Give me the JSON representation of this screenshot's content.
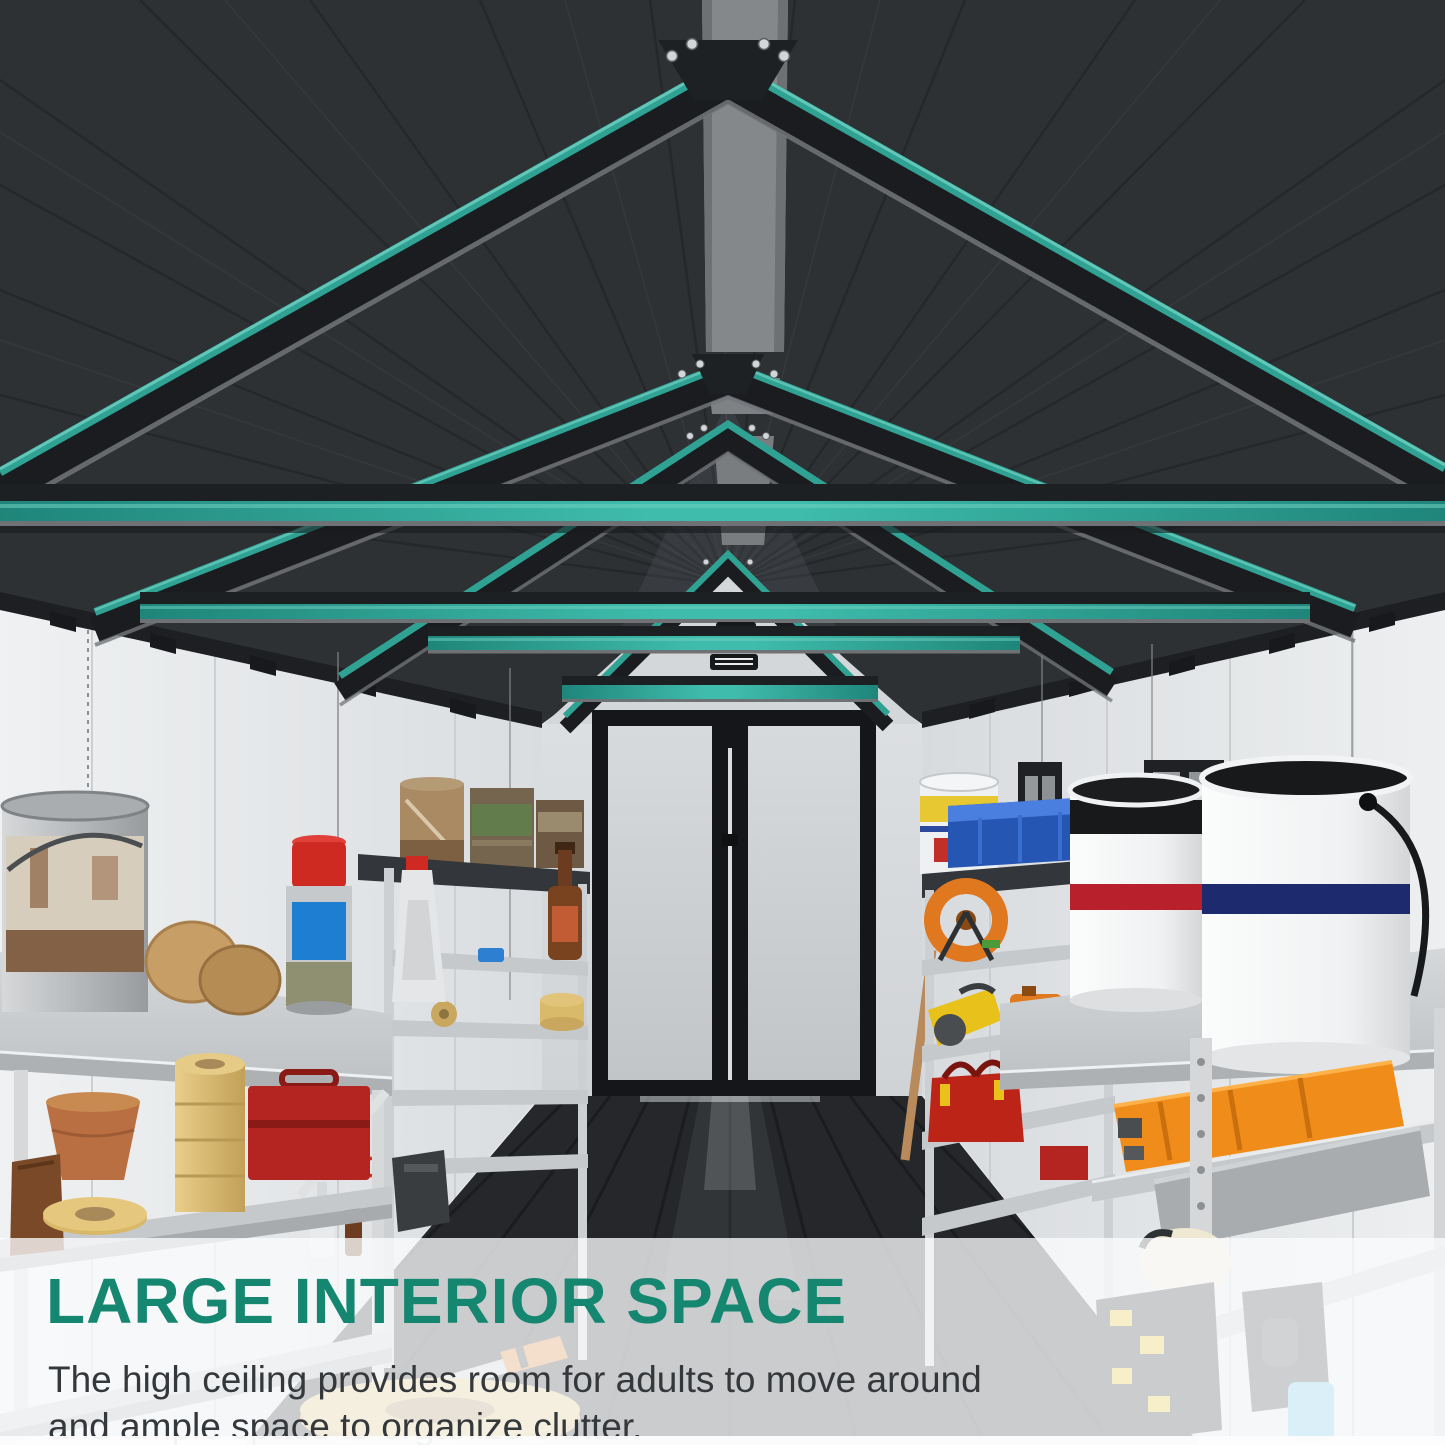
{
  "page": {
    "width": 1445,
    "height": 1445
  },
  "overlay": {
    "title": "LARGE INTERIOR SPACE",
    "description_line1": "The high ceiling provides room for adults to move around",
    "description_line2": "and ample space to organize clutter.",
    "title_color": "#15866F",
    "description_color": "#35383B",
    "panel_color": "rgba(250,251,252,0.78)"
  },
  "scene": {
    "setting": "storage-shed-interior-3d-render",
    "accent_color": "#2FA294",
    "accent_bright": "#6FD0C0",
    "roof_color": "#2E3134",
    "ridge_color": "#85888B",
    "wall_color": "#E9EBEC",
    "back_wall_color": "#D9DCDE",
    "gable_color": "#D4D7D9",
    "floor_color": "#25272B",
    "shelf_color": "#C8CBCE",
    "door": {
      "type": "double-door",
      "frame_color": "#17191C",
      "panel_color": "#CFD2D5"
    },
    "trusses": {
      "count": 4,
      "highlight": "teal",
      "screws_per_apex": 4
    },
    "collar_beams": {
      "count": 4,
      "highlight": "teal"
    },
    "vents": {
      "count": 2
    },
    "windows": {
      "count": 2
    },
    "left_shelf_items": [
      "large-paint-can",
      "wood-discs",
      "spray-can",
      "squeeze-bottle",
      "rusty-bucket",
      "canned-goods-stack",
      "amber-bottle",
      "yellow-tape-rolls",
      "red-toolbox",
      "tape-roll-stack",
      "terracotta-pot",
      "leather-bag",
      "flat-tape-roll",
      "big-tape-roll",
      "screwdriver",
      "scissors",
      "tool-roll",
      "small-bottles"
    ],
    "right_shelf_items": [
      "yellow-band-bucket",
      "blue-tool-case",
      "red-stripe-bucket",
      "navy-stripe-bucket",
      "cable-reel",
      "circular-saw",
      "orange-jerrycan",
      "red-tool-bag",
      "orange-hard-case",
      "metal-tray-case",
      "work-light",
      "black-toolbox",
      "power-drill"
    ]
  }
}
